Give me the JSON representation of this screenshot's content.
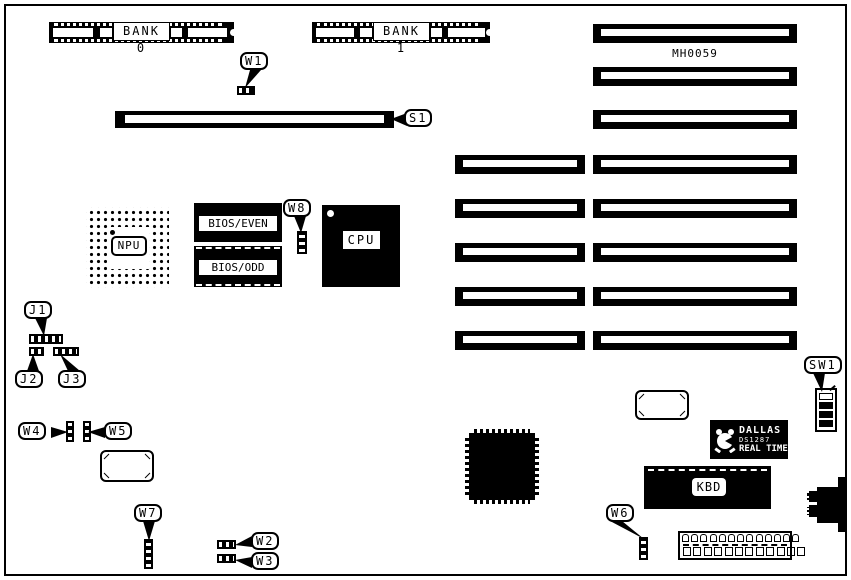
{
  "figure": {
    "part_number": "MH0059"
  },
  "memory": {
    "bank0": "BANK 0",
    "bank1": "BANK 1"
  },
  "chips": {
    "npu": "NPU",
    "cpu": "CPU",
    "bios_even": "BIOS/EVEN",
    "bios_odd": "BIOS/ODD",
    "kbd": "KBD",
    "rtc_brand": "DALLAS",
    "rtc_part": "DS1287",
    "rtc_line": "REAL TIME"
  },
  "callouts": {
    "s1": "S1",
    "w1": "W1",
    "w2": "W2",
    "w3": "W3",
    "w4": "W4",
    "w5": "W5",
    "w6": "W6",
    "w7": "W7",
    "w8": "W8",
    "j1": "J1",
    "j2": "J2",
    "j3": "J3",
    "sw1": "SW1"
  },
  "connectors": {
    "power_top_pins": 13,
    "power_bottom_pins": 12
  }
}
